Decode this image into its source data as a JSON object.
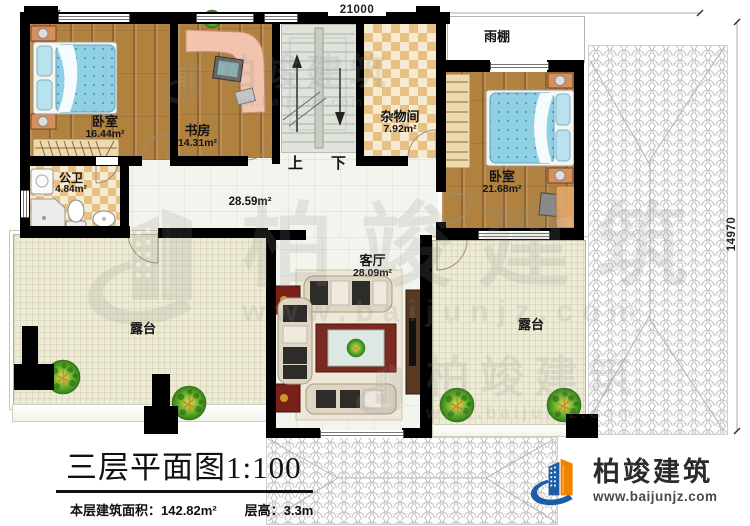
{
  "dimensions": {
    "width": "21000",
    "height": "14970"
  },
  "rooms": {
    "bedroom1": {
      "name": "卧室",
      "area": "16.44m²"
    },
    "study": {
      "name": "书房",
      "area": "14.31m²"
    },
    "storage": {
      "name": "杂物间",
      "area": "7.92m²"
    },
    "canopy": {
      "name": "雨棚"
    },
    "bedroom2": {
      "name": "卧室",
      "area": "21.68m²"
    },
    "bathroom": {
      "name": "公卫",
      "area": "4.84m²"
    },
    "hall": {
      "area": "28.59m²"
    },
    "living": {
      "name": "客厅",
      "area": "28.09m²"
    },
    "terrace_left": {
      "name": "露台"
    },
    "terrace_right": {
      "name": "露台"
    }
  },
  "stairs": {
    "up": "上",
    "down": "下"
  },
  "title_block": {
    "title": "三层平面图",
    "scale": "1:100",
    "floor_area": "本层建筑面积：142.82m²",
    "floor_height": "层高：3.3m"
  },
  "brand": {
    "name": "柏竣建筑",
    "website": "www.baijunjz.com"
  },
  "watermark": {
    "name": "柏竣建筑",
    "website": "www.baijunjz.com"
  },
  "colors": {
    "wall": "#000000",
    "wood_floor": "#b1813f",
    "mattress_blue": "#8fd0e4",
    "terrace_floor": "#edead5",
    "brand_blue": "#1b5ea6",
    "brand_orange": "#f08300"
  }
}
